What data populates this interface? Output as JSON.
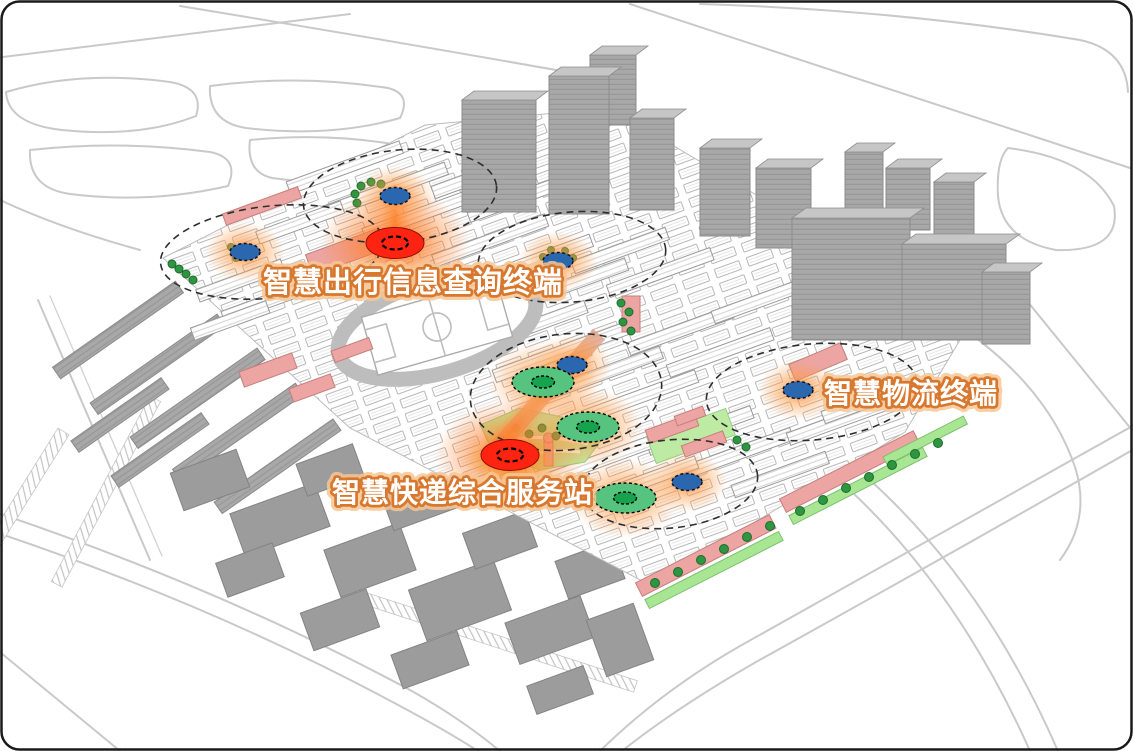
{
  "labels": {
    "travel_terminal": "智慧出行信息查询终端",
    "express_station": "智慧快递综合服务站",
    "logistics_terminal": "智慧物流终端"
  },
  "markers": {
    "red_spot_marker": {
      "color_key": "marker_red",
      "count": 2
    },
    "blue_dot_marker": {
      "color_key": "marker_blue",
      "count": 6
    },
    "green_ring_marker": {
      "color_key": "marker_green_ring",
      "count": 3
    },
    "coverage_zone_count": 6
  },
  "colors": {
    "marker_red": "#FF2412",
    "marker_blue": "#2A67AE",
    "marker_green_ring": "#56C47E",
    "marker_green_core": "#17A24D",
    "glow_orange": "#FF8C33",
    "label_fill": "#FFFFFF",
    "label_stroke": "#D8772E",
    "building_pink": "#ECA5A2",
    "lawn_green": "#BDEBA4",
    "tree_green": "#2E9641",
    "context_gray": "#A5A5A5",
    "road_gray": "#C9C9C9"
  }
}
